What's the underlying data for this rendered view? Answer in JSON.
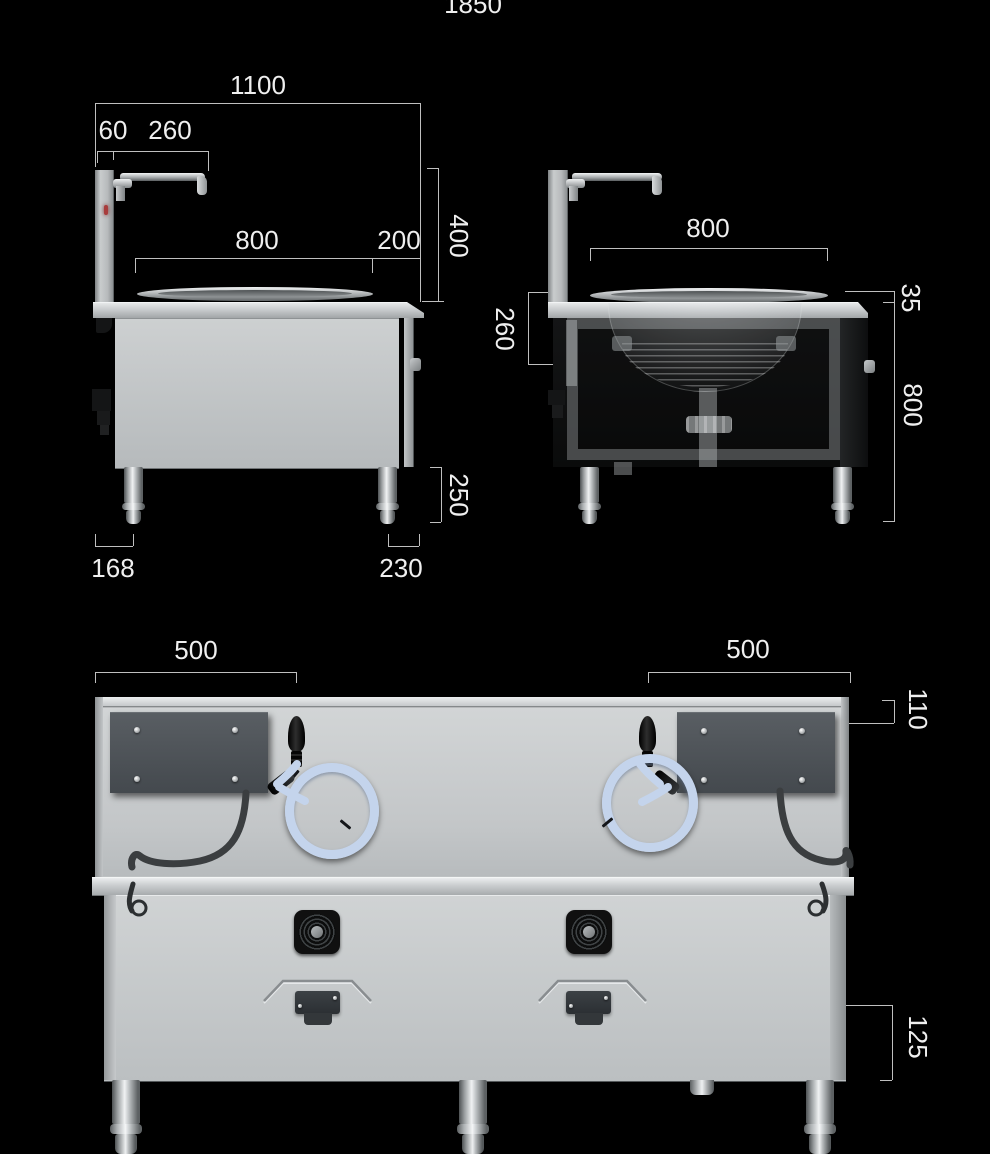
{
  "diagram": {
    "title_total_width": "1850",
    "side_view": {
      "width_total": "1100",
      "backsplash_thickness": "60",
      "faucet_reach": "260",
      "counter_depth": "800",
      "front_edge": "200",
      "upper_section_height": "400",
      "leg_height": "250",
      "rear_leg_offset": "168",
      "front_leg_offset": "230"
    },
    "front_view": {
      "wok_opening_width": "800",
      "wok_bowl_depth": "260",
      "counter_edge_thickness": "35",
      "cabinet_height": "800"
    },
    "back_view": {
      "left_span": "500",
      "right_span": "500",
      "top_offset": "110",
      "bottom_panel_height": "125"
    }
  }
}
